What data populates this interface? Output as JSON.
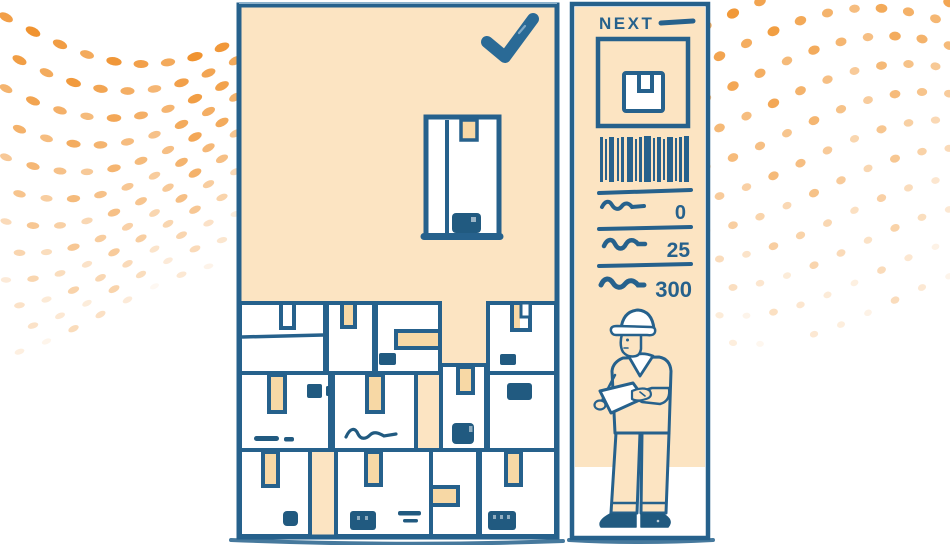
{
  "scene": {
    "description_icon": "warehouse-box-stacking-game-illustration",
    "background_icon": "halftone-dots",
    "worker_icon": "warehouse-worker-with-clipboard"
  },
  "board": {
    "check_icon": "check-icon",
    "falling_box_icon": "package-box-icon",
    "stacked_box_count": 12,
    "rows": 3
  },
  "sidebar": {
    "next_label": "NEXT",
    "dash_icon": "dash-icon",
    "preview_icon": "box-icon",
    "barcode_icon": "barcode-icon",
    "stats": [
      {
        "icon": "squiggle-label",
        "value": "0"
      },
      {
        "icon": "squiggle-label",
        "value": "25"
      },
      {
        "icon": "squiggle-label",
        "value": "300"
      }
    ]
  },
  "colors": {
    "ink": "#26618c",
    "ink_dark": "#215a80",
    "panel_fill": "#fce4c2",
    "tape": "#f7d8a5",
    "dot_orange": "#ef8d25",
    "check_blue": "#2a6a96",
    "white": "#ffffff"
  }
}
